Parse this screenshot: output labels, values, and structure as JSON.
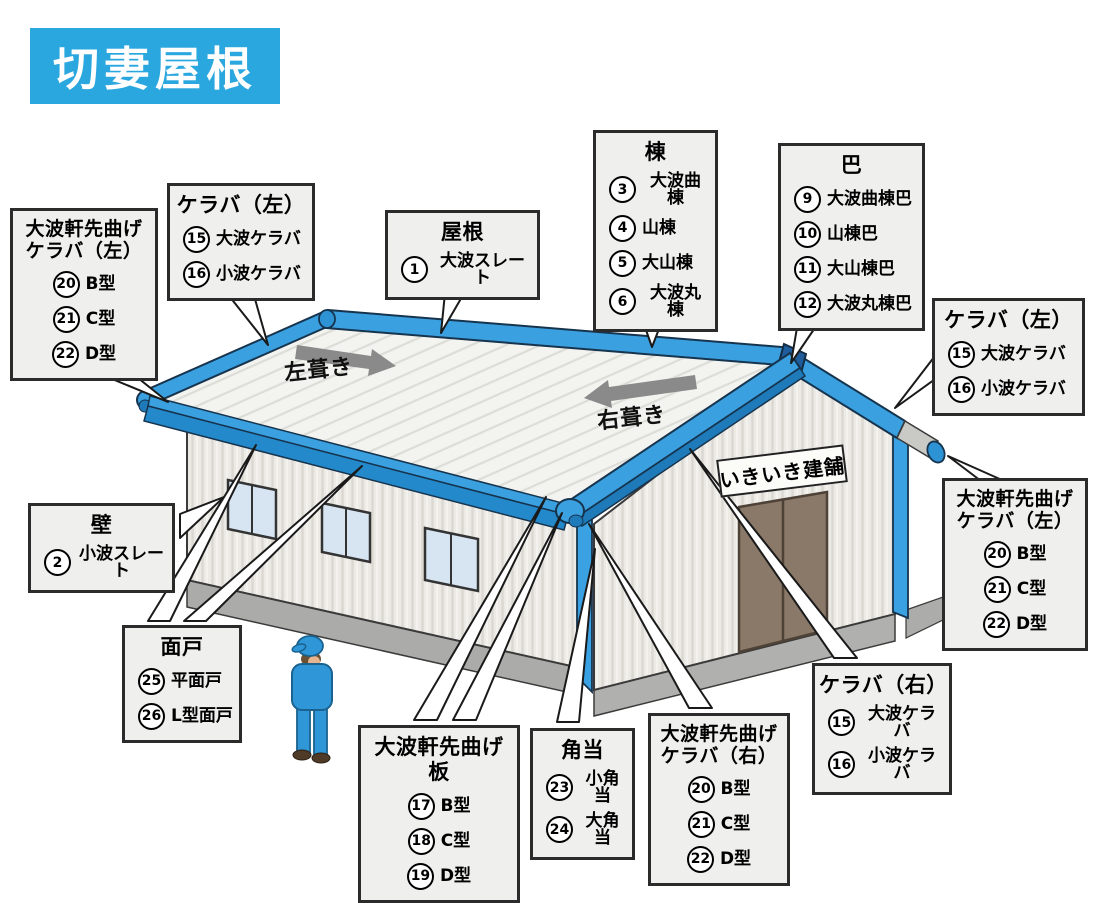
{
  "title": "切妻屋根",
  "colors": {
    "accent_blue": "#2AA7DF",
    "roof_trim_blue": "#3AA0E0",
    "trim_dark_blue": "#1E7AB8",
    "ridge_cap_navy": "#1F5C9B",
    "callout_bg": "#EFEFEE",
    "arrow_gray": "#8A8A8A",
    "door_brown": "#8A7968",
    "worker_blue": "#2F97D8"
  },
  "building": {
    "sign": "いきいき建舗",
    "fuki_left": "左葺き",
    "fuki_right": "右葺き"
  },
  "callouts": [
    {
      "title": "大波軒先曲げ\nケラバ（左）",
      "items": [
        {
          "num": "20",
          "label": "B型"
        },
        {
          "num": "21",
          "label": "C型"
        },
        {
          "num": "22",
          "label": "D型"
        }
      ]
    },
    {
      "title": "ケラバ（左）",
      "items": [
        {
          "num": "15",
          "label": "大波ケラバ"
        },
        {
          "num": "16",
          "label": "小波ケラバ"
        }
      ]
    },
    {
      "title": "屋根",
      "items": [
        {
          "num": "1",
          "label": "大波スレート"
        }
      ]
    },
    {
      "title": "棟",
      "items": [
        {
          "num": "3",
          "label": "大波曲棟"
        },
        {
          "num": "4",
          "label": "山棟"
        },
        {
          "num": "5",
          "label": "大山棟"
        },
        {
          "num": "6",
          "label": "大波丸棟"
        }
      ]
    },
    {
      "title": "巴",
      "items": [
        {
          "num": "9",
          "label": "大波曲棟巴"
        },
        {
          "num": "10",
          "label": "山棟巴"
        },
        {
          "num": "11",
          "label": "大山棟巴"
        },
        {
          "num": "12",
          "label": "大波丸棟巴"
        }
      ]
    },
    {
      "title": "ケラバ（左）",
      "items": [
        {
          "num": "15",
          "label": "大波ケラバ"
        },
        {
          "num": "16",
          "label": "小波ケラバ"
        }
      ]
    },
    {
      "title": "大波軒先曲げ\nケラバ（左）",
      "items": [
        {
          "num": "20",
          "label": "B型"
        },
        {
          "num": "21",
          "label": "C型"
        },
        {
          "num": "22",
          "label": "D型"
        }
      ]
    },
    {
      "title": "壁",
      "items": [
        {
          "num": "2",
          "label": "小波スレート"
        }
      ]
    },
    {
      "title": "面戸",
      "items": [
        {
          "num": "25",
          "label": "平面戸"
        },
        {
          "num": "26",
          "label": "L型面戸"
        }
      ]
    },
    {
      "title": "大波軒先曲げ板",
      "items": [
        {
          "num": "17",
          "label": "B型"
        },
        {
          "num": "18",
          "label": "C型"
        },
        {
          "num": "19",
          "label": "D型"
        }
      ]
    },
    {
      "title": "角当",
      "items": [
        {
          "num": "23",
          "label": "小角当"
        },
        {
          "num": "24",
          "label": "大角当"
        }
      ]
    },
    {
      "title": "大波軒先曲げ\nケラバ（右）",
      "items": [
        {
          "num": "20",
          "label": "B型"
        },
        {
          "num": "21",
          "label": "C型"
        },
        {
          "num": "22",
          "label": "D型"
        }
      ]
    },
    {
      "title": "ケラバ（右）",
      "items": [
        {
          "num": "15",
          "label": "大波ケラバ"
        },
        {
          "num": "16",
          "label": "小波ケラバ"
        }
      ]
    }
  ]
}
